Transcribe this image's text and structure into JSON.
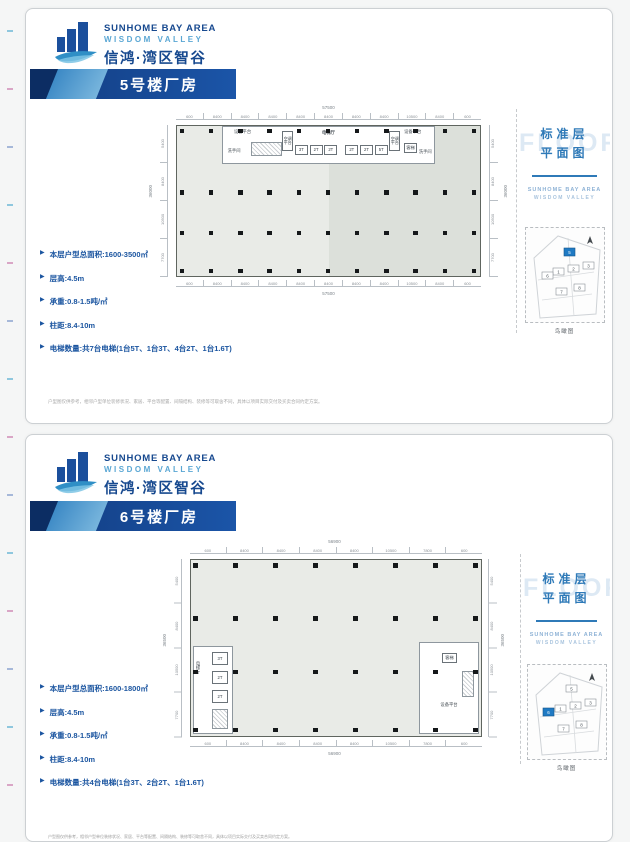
{
  "brand": {
    "en": "SUNHOME BAY AREA",
    "sub": "WISDOM VALLEY",
    "cn": "信鸿·湾区智谷"
  },
  "sidebar": {
    "title_l1": "标准层",
    "title_l2": "平面图",
    "watermark": "FLOOR",
    "brand1": "SUNHOME BAY AREA",
    "brand2": "WISDOM VALLEY",
    "caption": "鸟瞰图",
    "map_numbers": [
      "1",
      "2",
      "3",
      "5",
      "6",
      "7",
      "8"
    ]
  },
  "pages": {
    "p1": {
      "banner": "5号楼厂房",
      "bullets": [
        "本层户型总面积:1600-3500㎡",
        "层高:4.5m",
        "承重:0.8-1.5吨/㎡",
        "柱距:8.4-10m",
        "电梯数量:共7台电梯(1台5T、1台3T、4台2T、1台1.6T)"
      ],
      "disclaimer": "户型图仅供参考，相邻户型单位装修状况、家居、平台等配置、间隔结构、装修等可取舍不同，具体以项目实际交付及买卖合同约定方案。",
      "plan": {
        "total_w": "57500",
        "total_h": "36000",
        "dims_top": [
          "600",
          "8400",
          "8400",
          "8400",
          "8400",
          "8400",
          "8400",
          "8400",
          "10500",
          "8400",
          "600"
        ],
        "dims_left": [
          "5400",
          "8400",
          "10500",
          "7700"
        ],
        "labels": {
          "equip": "设备平台",
          "wc": "洗手间",
          "ac": "空调平台",
          "hall": "电梯厅",
          "guest": "客梯"
        },
        "lifts": [
          "3T",
          "2T",
          "2T",
          "2T",
          "2T",
          "5T"
        ]
      }
    },
    "p2": {
      "banner": "6号楼厂房",
      "bullets": [
        "本层户型总面积:1600-1800㎡",
        "层高:4.5m",
        "承重:0.8-1.5吨/㎡",
        "柱距:8.4-10m",
        "电梯数量:共4台电梯(1台3T、2台2T、1台1.6T)"
      ],
      "footer": "户型图仅供参考，相邻户型单位装修状况、家居、平台等配置、间隔结构、装修等可取舍不同，具体以项目实际交付及买卖合同约定方案。",
      "plan": {
        "total_w": "56900",
        "total_h": "36500",
        "dims_top": [
          "600",
          "8400",
          "8400",
          "8400",
          "8400",
          "10500",
          "7800",
          "600"
        ],
        "dims_left": [
          "5400",
          "8400",
          "10500",
          "7700"
        ],
        "labels": {
          "equip": "设备平台",
          "hall": "电梯厅",
          "guest": "客梯"
        },
        "lifts": [
          "3T",
          "2T",
          "2T"
        ]
      }
    }
  }
}
